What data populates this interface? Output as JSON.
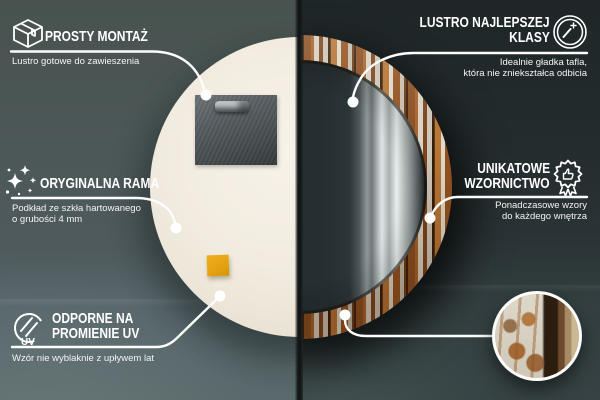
{
  "language": "pl",
  "colors": {
    "left_wall": "#4e5a5c",
    "right_wall": "#2a3335",
    "callout_white": "#ffffff",
    "mirror_back_cream": "#f1ebdf",
    "sticky_note_yellow": "#e9a713",
    "frame_wood_brown": "#8a4e22"
  },
  "callouts": {
    "prosty_montaz": {
      "icon": "package-box-icon",
      "title": "PROSTY MONTAŻ",
      "subtitle": "Lustro gotowe do zawieszenia"
    },
    "oryginalna_rama": {
      "icon": "sparkles-icon",
      "title": "ORYGINALNA RAMA",
      "subtitle_line1": "Podkład ze szkła hartowanego",
      "subtitle_line2": "o grubości 4 mm"
    },
    "odporne_uv": {
      "icon": "uv-protection-icon",
      "uv_label": "UV",
      "title_line1": "ODPORNE NA",
      "title_line2": "PROMIENIE UV",
      "subtitle": "Wzór nie wyblaknie z upływem lat"
    },
    "lustro_najlepszej_klasy": {
      "icon": "mirror-shine-icon",
      "title_line1": "LUSTRO NAJLEPSZEJ",
      "title_line2": "KLASY",
      "subtitle_line1": "Idealnie gładka tafla,",
      "subtitle_line2": "która nie zniekształca odbicia"
    },
    "unikatowe_wzornictwo": {
      "icon": "quality-badge-icon",
      "title_line1": "UNIKATOWE",
      "title_line2": "WZORNICTWO",
      "subtitle_line1": "Ponadczasowe wzory",
      "subtitle_line2": "do każdego wnętrza"
    }
  },
  "scene": {
    "left_photo": "back of round mirror with mounting plate and hook",
    "right_photo": "front of round decorative mirror with rustic wood frame",
    "inset": "zoomed detail of peeling-paint wood texture"
  }
}
